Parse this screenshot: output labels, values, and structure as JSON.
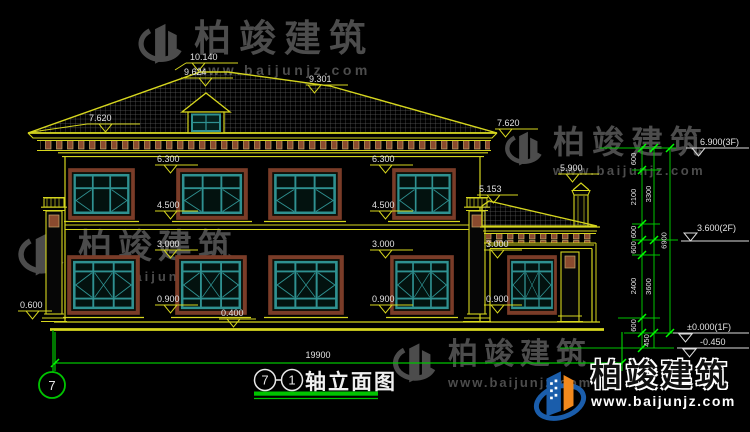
{
  "drawing": {
    "title": {
      "axis_from": "7",
      "separator": "-",
      "axis_to": "1",
      "name": "轴立面图"
    },
    "axis_bubble": "7"
  },
  "levels": {
    "ridge": "10.140",
    "dormer_ridge": "9.624",
    "ridge_right": "9.301",
    "eave_left": "7.620",
    "eave_right": "7.620",
    "cornice_left": "6.300",
    "cornice_mid": "6.300",
    "chimney_top": "5.900",
    "porch_ridge": "5.153",
    "sill2_left": "4.500",
    "sill2_mid": "4.500",
    "lintel1_left": "3.000",
    "lintel1_mid": "3.000",
    "lintel1_porch": "3.000",
    "sill1_left": "0.900",
    "sill1_mid": "0.900",
    "sill1_porch": "0.900",
    "plinth": "0.400",
    "plinth_left": "0.600"
  },
  "dim_chain": {
    "seg_600": "600",
    "seg_2100": "2100",
    "seg_2400": "2400",
    "seg_450": "450",
    "sub_3300": "3300",
    "sub_3600": "3600",
    "total_height": "6900",
    "overall_width": "19900"
  },
  "floor_marks": {
    "f3": "6.900(3F)",
    "f2": "3.600(2F)",
    "f1": "±0.000(1F)",
    "ground": "-0.450"
  },
  "watermark": {
    "brand": "柏竣建筑",
    "url": "www.baijunjz.com"
  },
  "footer_logo": {
    "brand": "柏竣建筑",
    "url": "www.baijunjz.com"
  },
  "colors": {
    "line_yellow": "#d6d61e",
    "dim_green": "#00c400",
    "tick_green": "#00ff00",
    "frame_teal": "#2f9191",
    "trim_brown": "#7a3c28",
    "text_white": "#e2e2e2",
    "logo_blue": "#1a5dab",
    "logo_orange": "#f2891d",
    "watermark_grey": "#4c4c4c"
  }
}
